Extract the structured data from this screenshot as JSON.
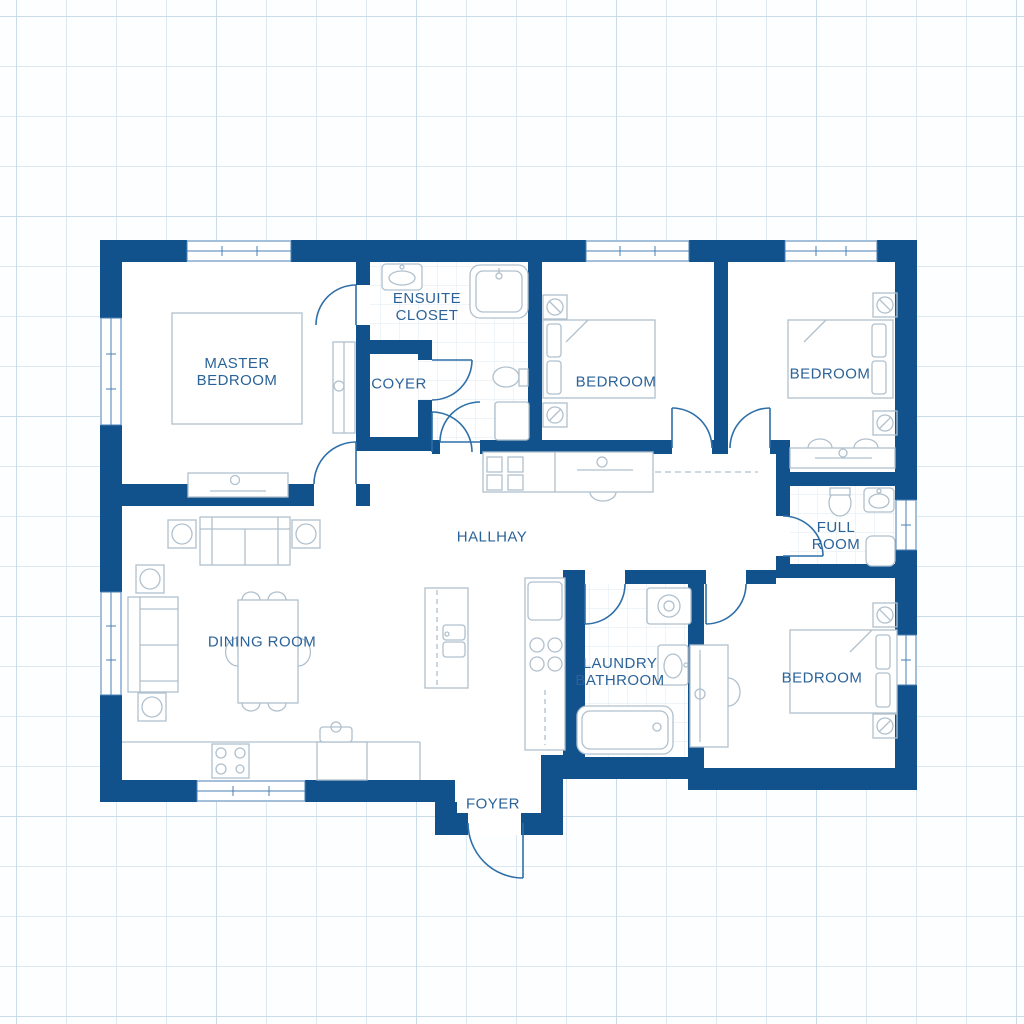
{
  "palette": {
    "wall": "#11518c",
    "label_text": "#2b6399",
    "door_arc": "#2e6fa8",
    "furniture_line": "#b0c0cd",
    "window_line": "#4a7fb5",
    "tile_line": "#dfeaf2",
    "grid_line": "#dce9f1",
    "background": "#fdfeff"
  },
  "rooms": {
    "master_bedroom": {
      "label": "MASTER\nBEDROOM"
    },
    "ensuite_closet": {
      "label": "ENSUITE\nCLOSET"
    },
    "coyer": {
      "label": "COYER"
    },
    "bedroom_top_middle": {
      "label": "BEDROOM"
    },
    "bedroom_top_right": {
      "label": "BEDROOM"
    },
    "hallway": {
      "label": "HALLHAY"
    },
    "full_room": {
      "label": "FULL\nROOM"
    },
    "dining_room": {
      "label": "DINING ROOM"
    },
    "laundry_bathroom": {
      "label": "LAUNDRY\nBATHROOM"
    },
    "bedroom_bottom_right": {
      "label": "BEDROOM"
    },
    "foyer": {
      "label": "FOYER"
    }
  }
}
